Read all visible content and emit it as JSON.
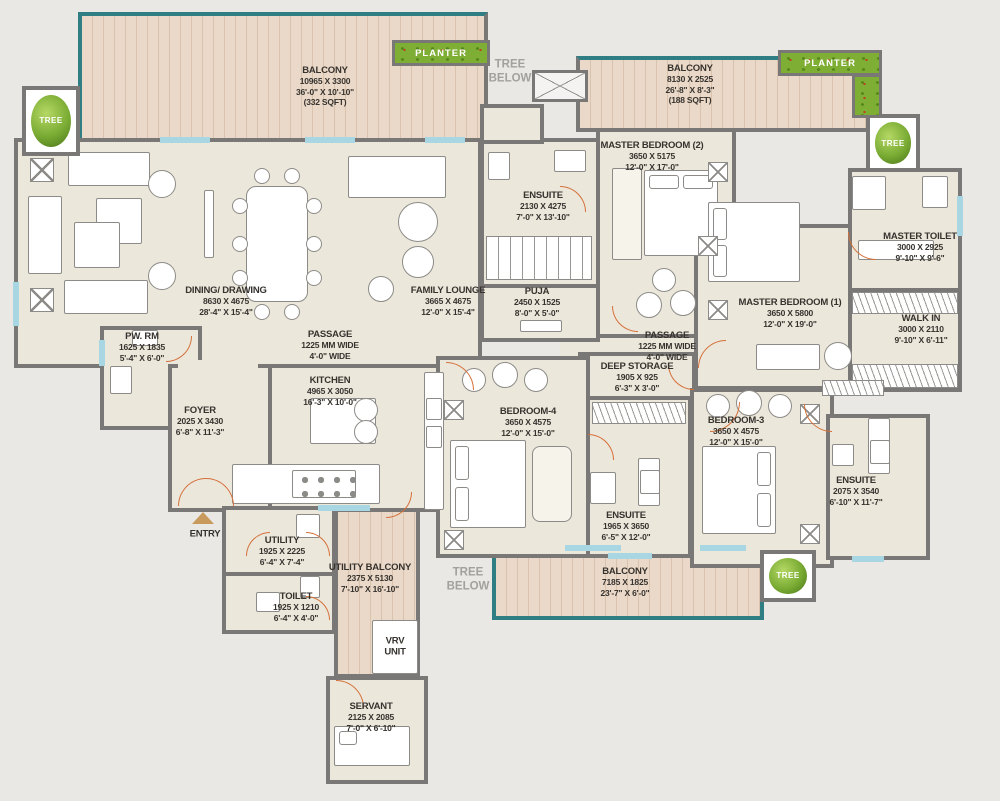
{
  "title": "Apartment Floor Plan",
  "colors": {
    "background": "#e9e8e5",
    "wall": "#7a7876",
    "floor": "#ece7db",
    "wood": "#ead9c8",
    "teal_edge": "#2f7e84",
    "door_arc": "#d4703a",
    "planter_green": "#7fae35",
    "label_text": "#36322e",
    "muted_text": "#a3a19d",
    "window": "#a9d6e3",
    "entry_arrow": "#c89a5e"
  },
  "rooms": {
    "balc_tl": {
      "name": "BALCONY",
      "mm": "10965 X 3300",
      "ft": "36'-0\" X 10'-10\"",
      "area": "(332 SQFT)"
    },
    "balc_tr": {
      "name": "BALCONY",
      "mm": "8130 X 2525",
      "ft": "26'-8\" X 8'-3\"",
      "area": "(188 SQFT)"
    },
    "balc_b": {
      "name": "BALCONY",
      "mm": "7185 X 1825",
      "ft": "23'-7\" X 6'-0\""
    },
    "utilbalc": {
      "name": "UTILITY BALCONY",
      "mm": "2375 X 5130",
      "ft": "7'-10\" X 16'-10\""
    },
    "mb2": {
      "name": "MASTER BEDROOM (2)",
      "mm": "3650 X 5175",
      "ft": "12'-0\" X 17'-0\""
    },
    "mb1": {
      "name": "MASTER BEDROOM (1)",
      "mm": "3650 X 5800",
      "ft": "12'-0\" X 19'-0\""
    },
    "ens_top": {
      "name": "ENSUITE",
      "mm": "2130 X 4275",
      "ft": "7'-0\" X 13'-10\""
    },
    "puja": {
      "name": "PUJA",
      "mm": "2450 X 1525",
      "ft": "8'-0\" X 5'-0\""
    },
    "mtoilet": {
      "name": "MASTER TOILET",
      "mm": "3000 X 2925",
      "ft": "9'-10\" X 9'-6\""
    },
    "walkin": {
      "name": "WALK IN",
      "mm": "3000 X 2110",
      "ft": "9'-10\" X 6'-11\""
    },
    "dining": {
      "name": "DINING/ DRAWING",
      "mm": "8630 X 4675",
      "ft": "28'-4\" X 15'-4\""
    },
    "famlounge": {
      "name": "FAMILY LOUNGE",
      "mm": "3665 X 4675",
      "ft": "12'-0\" X 15'-4\""
    },
    "passage_l": {
      "name": "PASSAGE",
      "mm": "1225 MM WIDE",
      "ft": "4'-0\" WIDE"
    },
    "passage_r": {
      "name": "PASSAGE",
      "mm": "1225 MM WIDE",
      "ft": "4'-0\" WIDE"
    },
    "pwrm": {
      "name": "PW. RM",
      "mm": "1625 X 1835",
      "ft": "5'-4\" X 6'-0\""
    },
    "foyer": {
      "name": "FOYER",
      "mm": "2025 X 3430",
      "ft": "6'-8\" X 11'-3\""
    },
    "kitchen": {
      "name": "KITCHEN",
      "mm": "4965 X 3050",
      "ft": "16'-3\" X 10'-0\""
    },
    "deepstore": {
      "name": "DEEP STORAGE",
      "mm": "1905 X 925",
      "ft": "6'-3\" X 3'-0\""
    },
    "bed4": {
      "name": "BEDROOM-4",
      "mm": "3650 X 4575",
      "ft": "12'-0\" X 15'-0\""
    },
    "bed3": {
      "name": "BEDROOM-3",
      "mm": "3650 X 4575",
      "ft": "12'-0\" X 15'-0\""
    },
    "ens4": {
      "name": "ENSUITE",
      "mm": "1965 X 3650",
      "ft": "6'-5\" X 12'-0\""
    },
    "ens3": {
      "name": "ENSUITE",
      "mm": "2075 X 3540",
      "ft": "6'-10\" X 11'-7\""
    },
    "utility": {
      "name": "UTILITY",
      "mm": "1925 X 2225",
      "ft": "6'-4\" X 7'-4\""
    },
    "toilet": {
      "name": "TOILET",
      "mm": "1925 X 1210",
      "ft": "6'-4\" X 4'-0\""
    },
    "servant": {
      "name": "SERVANT",
      "mm": "2125 X 2085",
      "ft": "7'-0\" X 6'-10\""
    }
  },
  "misc": {
    "planter": "PLANTER",
    "tree": "TREE",
    "tree_below": "TREE BELOW",
    "entry": "ENTRY",
    "vrv": "VRV UNIT"
  }
}
